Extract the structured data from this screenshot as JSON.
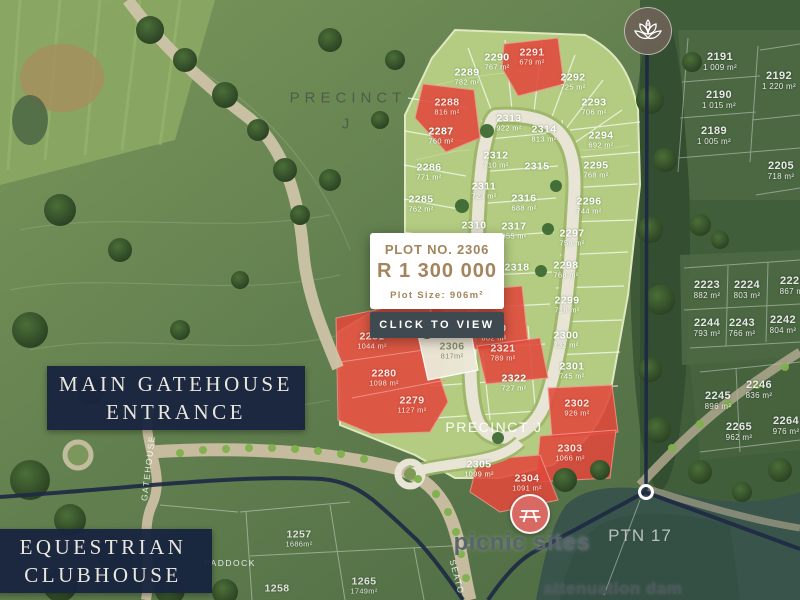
{
  "popup": {
    "title": "PLOT NO. 2306",
    "price": "R 1 300 000",
    "size": "Plot Size: 906m²",
    "cta": "CLICK TO VIEW"
  },
  "place_boxes": {
    "gatehouse": {
      "line1": "MAIN GATEHOUSE",
      "line2": "ENTRANCE"
    },
    "clubhouse": {
      "line1": "EQUESTRIAN",
      "line2": "CLUBHOUSE"
    }
  },
  "map": {
    "region_labels": [
      {
        "text": "PRECINCT",
        "x": 348,
        "y": 98,
        "cls": "precinct-top"
      },
      {
        "text": "J",
        "x": 348,
        "y": 124,
        "cls": "precinct-top"
      },
      {
        "text": "PRECINCT J",
        "x": 494,
        "y": 427,
        "cls": "precinct-center"
      },
      {
        "text": "picnic sites",
        "x": 522,
        "y": 543,
        "cls": "picnic"
      },
      {
        "text": "attenuation dam",
        "x": 613,
        "y": 589,
        "cls": "dam"
      },
      {
        "text": "PTN 17",
        "x": 640,
        "y": 536,
        "cls": "ptn"
      },
      {
        "text": "PADDOCK",
        "x": 230,
        "y": 563,
        "cls": "small-road"
      },
      {
        "text": "GATEHOUSE",
        "x": 148,
        "y": 468,
        "cls": "small-road",
        "rot": -83
      },
      {
        "text": "SEATO",
        "x": 457,
        "y": 577,
        "cls": "small-road",
        "rot": 75
      }
    ],
    "plots": [
      {
        "number": "2290",
        "area": "767 m²",
        "x": 497,
        "y": 62,
        "status": "available"
      },
      {
        "number": "2289",
        "area": "782 m²",
        "x": 467,
        "y": 77,
        "status": "available"
      },
      {
        "number": "2287",
        "area": "760 m²",
        "x": 441,
        "y": 136,
        "status": "available"
      },
      {
        "number": "2286",
        "area": "771 m²",
        "x": 429,
        "y": 172,
        "status": "available"
      },
      {
        "number": "2285",
        "area": "762 m²",
        "x": 421,
        "y": 204,
        "status": "available"
      },
      {
        "number": "2292",
        "area": "725 m²",
        "x": 573,
        "y": 82,
        "status": "available"
      },
      {
        "number": "2293",
        "area": "706 m²",
        "x": 594,
        "y": 107,
        "status": "available"
      },
      {
        "number": "2294",
        "area": "692 m²",
        "x": 601,
        "y": 140,
        "status": "available"
      },
      {
        "number": "2295",
        "area": "768 m²",
        "x": 596,
        "y": 170,
        "status": "available"
      },
      {
        "number": "2296",
        "area": "744 m²",
        "x": 589,
        "y": 206,
        "status": "available"
      },
      {
        "number": "2297",
        "area": "758 m²",
        "x": 572,
        "y": 238,
        "status": "available"
      },
      {
        "number": "2298",
        "area": "768 m²",
        "x": 566,
        "y": 270,
        "status": "available"
      },
      {
        "number": "2299",
        "area": "716 m²",
        "x": 567,
        "y": 305,
        "status": "available"
      },
      {
        "number": "2300",
        "area": "732 m²",
        "x": 566,
        "y": 340,
        "status": "available"
      },
      {
        "number": "2301",
        "area": "745 m²",
        "x": 572,
        "y": 371,
        "status": "available"
      },
      {
        "number": "2313",
        "area": "922 m²",
        "x": 509,
        "y": 123,
        "status": "available"
      },
      {
        "number": "2314",
        "area": "813 m²",
        "x": 544,
        "y": 134,
        "status": "available"
      },
      {
        "number": "2312",
        "area": "710 m²",
        "x": 496,
        "y": 160,
        "status": "available"
      },
      {
        "number": "2311",
        "area": "723 m²",
        "x": 484,
        "y": 191,
        "status": "available"
      },
      {
        "number": "2316",
        "area": "688 m²",
        "x": 524,
        "y": 203,
        "status": "available"
      },
      {
        "number": "2317",
        "area": "855 m²",
        "x": 514,
        "y": 231,
        "status": "available"
      },
      {
        "number": "2318",
        "area": "",
        "x": 517,
        "y": 268,
        "status": "available"
      },
      {
        "number": "2315",
        "area": "",
        "x": 537,
        "y": 167,
        "status": "available"
      },
      {
        "number": "2310",
        "area": "",
        "x": 474,
        "y": 226,
        "status": "available"
      },
      {
        "number": "2322",
        "area": "727 m²",
        "x": 514,
        "y": 383,
        "status": "available"
      },
      {
        "number": "2305",
        "area": "1099 m²",
        "x": 479,
        "y": 469,
        "status": "available"
      },
      {
        "number": "2291",
        "area": "679 m²",
        "x": 532,
        "y": 57,
        "status": "sold"
      },
      {
        "number": "2288",
        "area": "816 m²",
        "x": 447,
        "y": 107,
        "status": "sold"
      },
      {
        "number": "2281",
        "area": "1044 m²",
        "x": 372,
        "y": 341,
        "status": "sold"
      },
      {
        "number": "2280",
        "area": "1098 m²",
        "x": 384,
        "y": 378,
        "status": "sold"
      },
      {
        "number": "2279",
        "area": "1127 m²",
        "x": 412,
        "y": 405,
        "status": "sold"
      },
      {
        "number": "2321",
        "area": "789 m²",
        "x": 503,
        "y": 353,
        "status": "sold"
      },
      {
        "number": "2320",
        "area": "802 m²",
        "x": 494,
        "y": 333,
        "status": "sold"
      },
      {
        "number": "",
        "area": "649 m²",
        "x": 437,
        "y": 332,
        "status": "sold"
      },
      {
        "number": "2302",
        "area": "926 m²",
        "x": 577,
        "y": 408,
        "status": "sold"
      },
      {
        "number": "2303",
        "area": "1066 m²",
        "x": 570,
        "y": 453,
        "status": "sold"
      },
      {
        "number": "2304",
        "area": "1091 m²",
        "x": 527,
        "y": 483,
        "status": "sold"
      },
      {
        "number": "2306",
        "area": "817m²",
        "x": 452,
        "y": 351,
        "status": "selected"
      },
      {
        "number": "2191",
        "area": "1 009 m²",
        "x": 720,
        "y": 62,
        "status": "outside"
      },
      {
        "number": "2190",
        "area": "1 015 m²",
        "x": 719,
        "y": 100,
        "status": "outside"
      },
      {
        "number": "2189",
        "area": "1 005 m²",
        "x": 714,
        "y": 136,
        "status": "outside"
      },
      {
        "number": "2192",
        "area": "1 220 m²",
        "x": 779,
        "y": 81,
        "status": "outside"
      },
      {
        "number": "2205",
        "area": "718 m²",
        "x": 781,
        "y": 171,
        "status": "outside"
      },
      {
        "number": "2223",
        "area": "882 m²",
        "x": 707,
        "y": 290,
        "status": "outside"
      },
      {
        "number": "2224",
        "area": "803 m²",
        "x": 747,
        "y": 290,
        "status": "outside"
      },
      {
        "number": "2225",
        "area": "867 m²",
        "x": 793,
        "y": 286,
        "status": "outside"
      },
      {
        "number": "2244",
        "area": "793 m²",
        "x": 707,
        "y": 328,
        "status": "outside"
      },
      {
        "number": "2243",
        "area": "766 m²",
        "x": 742,
        "y": 328,
        "status": "outside"
      },
      {
        "number": "2242",
        "area": "804 m²",
        "x": 783,
        "y": 325,
        "status": "outside"
      },
      {
        "number": "2246",
        "area": "836 m²",
        "x": 759,
        "y": 390,
        "status": "outside"
      },
      {
        "number": "2245",
        "area": "896 m²",
        "x": 718,
        "y": 401,
        "status": "outside"
      },
      {
        "number": "2265",
        "area": "962 m²",
        "x": 739,
        "y": 432,
        "status": "outside"
      },
      {
        "number": "2264",
        "area": "976 m²",
        "x": 786,
        "y": 426,
        "status": "outside"
      },
      {
        "number": "1257",
        "area": "1686m²",
        "x": 299,
        "y": 539,
        "status": "estate"
      },
      {
        "number": "1265",
        "area": "1749m²",
        "x": 364,
        "y": 586,
        "status": "estate"
      },
      {
        "number": "1258",
        "area": "",
        "x": 277,
        "y": 589,
        "status": "estate"
      }
    ],
    "markers": {
      "lotus": {
        "icon": "lotus-icon"
      },
      "picnic": {
        "icon": "picnic-table-icon"
      },
      "boundary_point": {
        "icon": "location-ring-icon"
      }
    },
    "colors": {
      "sold_red": "#e2493c",
      "available_green": "#b3cc82",
      "selected_cream": "#ece9d8",
      "accent_gold": "#a3845c",
      "navy": "#18243e",
      "button_slate": "#3e4a4f"
    }
  }
}
